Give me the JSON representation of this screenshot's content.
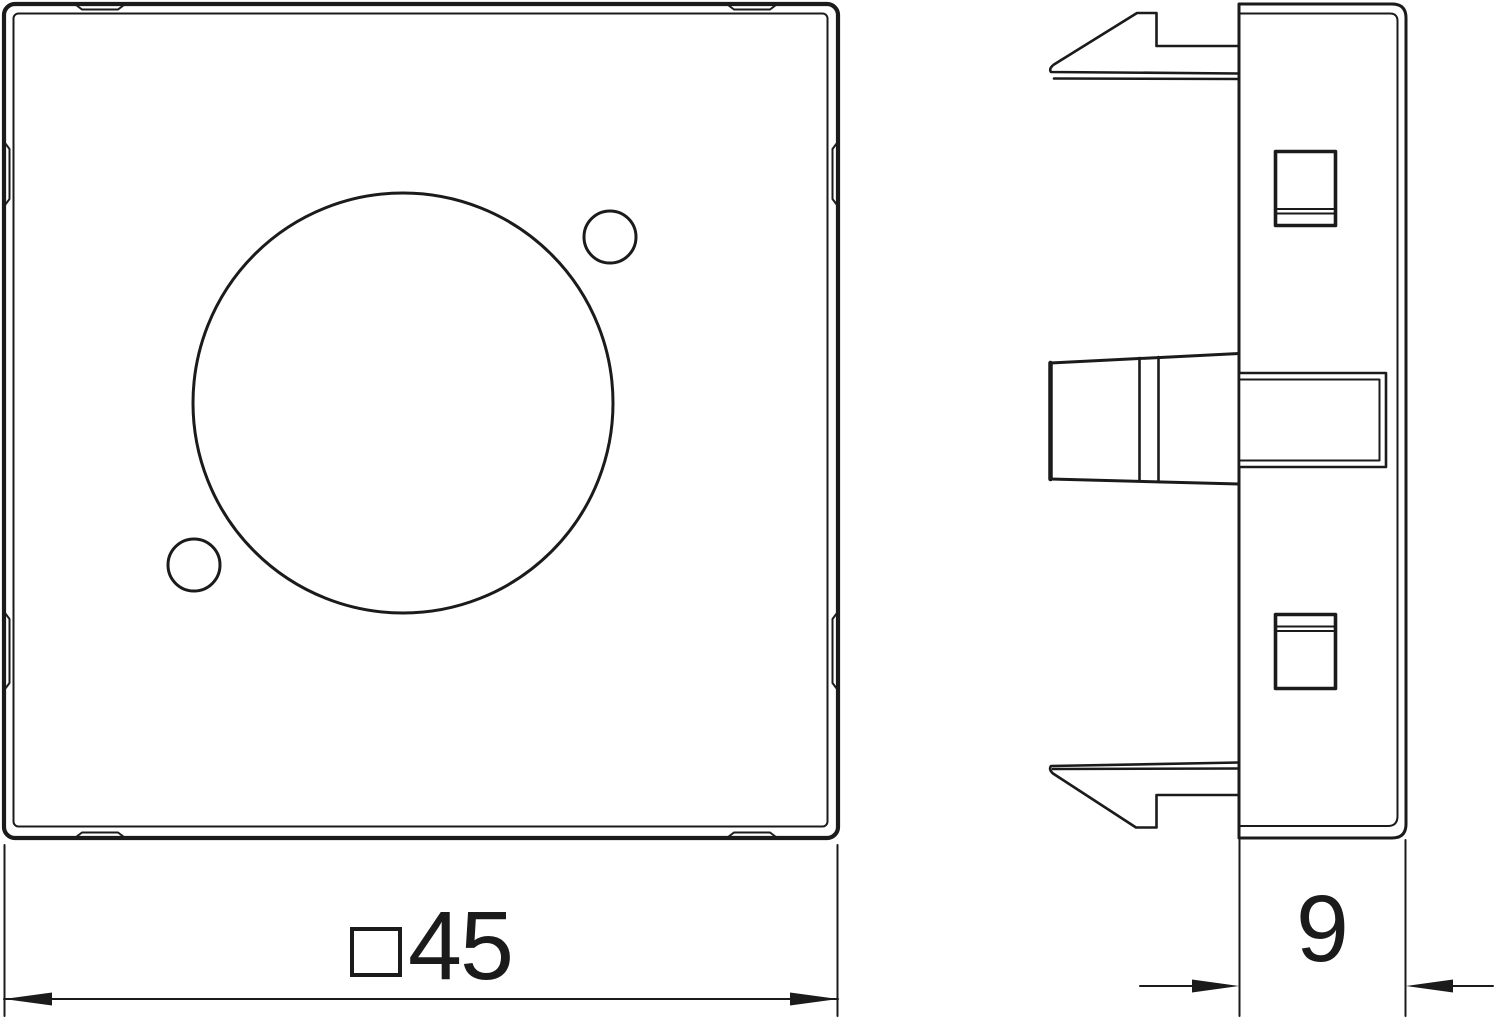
{
  "dimensions": {
    "width": {
      "symbol": "square",
      "value": "45"
    },
    "depth": {
      "value": "9"
    }
  },
  "colors": {
    "line": "#1b1b1b",
    "background": "#ffffff"
  }
}
